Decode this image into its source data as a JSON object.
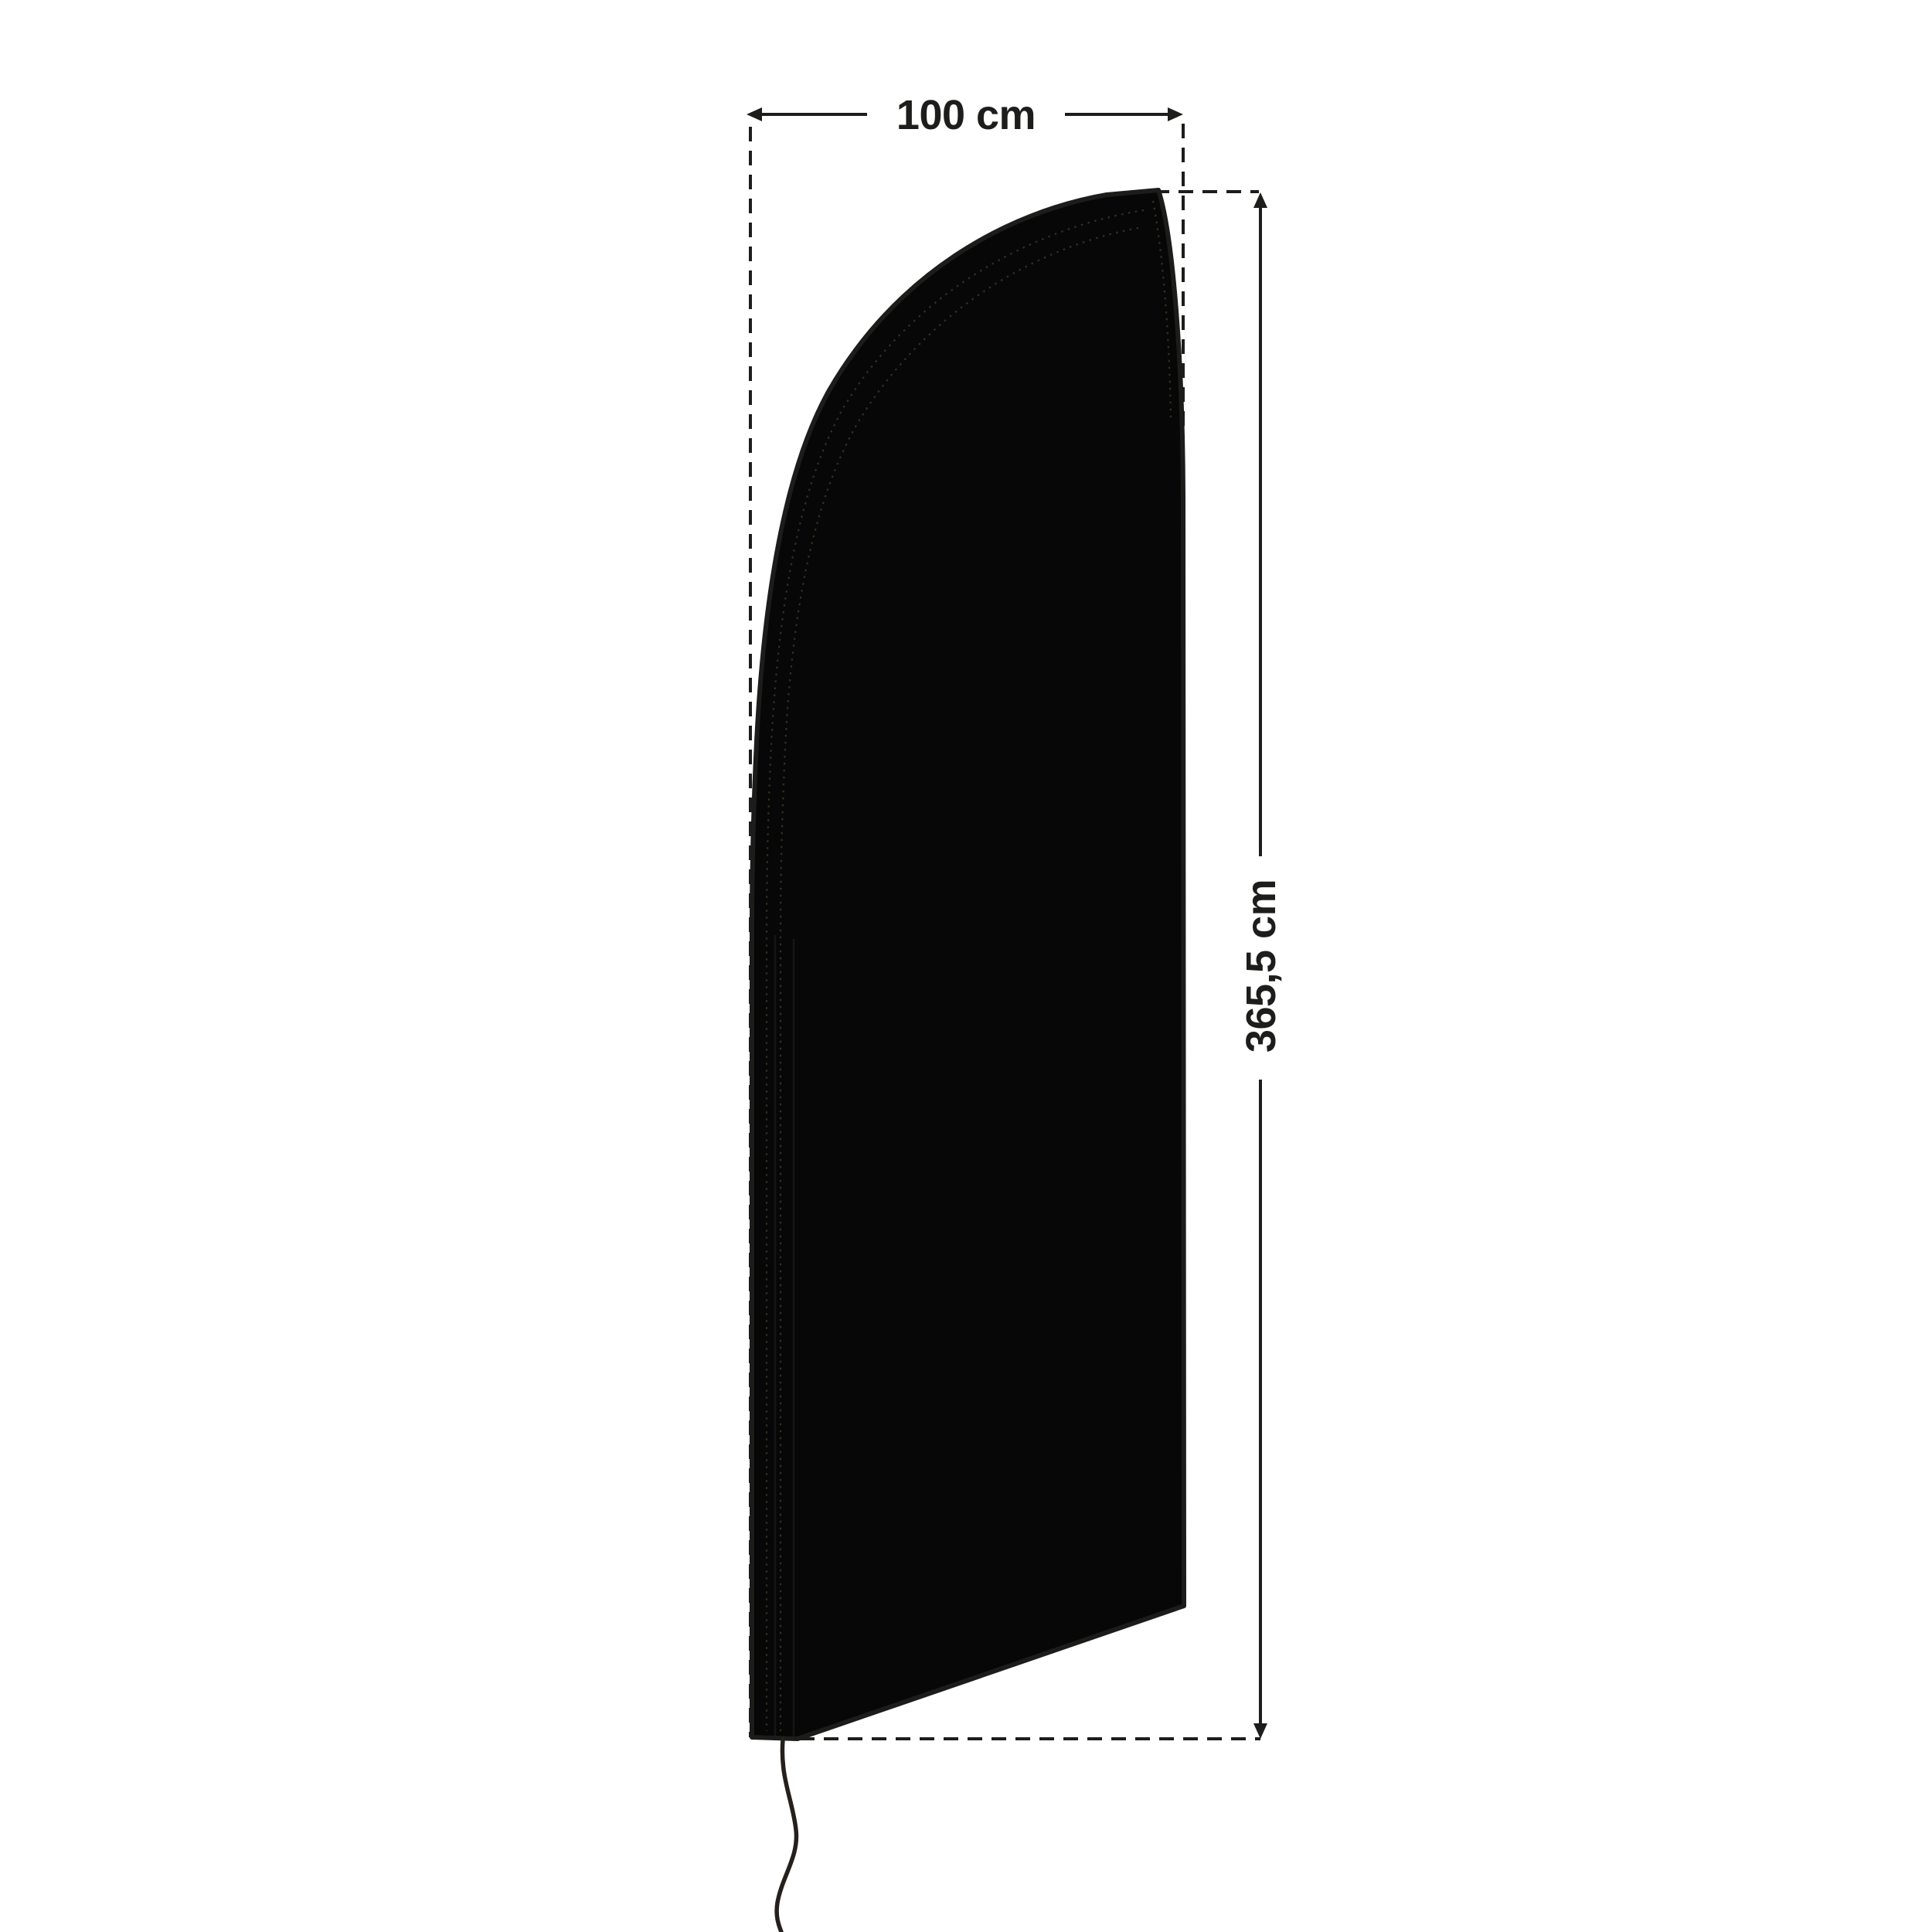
{
  "diagram": {
    "width_dimension": {
      "label": "100 cm"
    },
    "height_dimension": {
      "label": "365,5 cm"
    },
    "colors": {
      "background": "#ffffff",
      "flag_fill": "#070707",
      "flag_outline": "#1c1c1a",
      "dimension_line": "#1d1d1b",
      "stitch_seam": "#3a3a28",
      "cord": "#25201b"
    }
  }
}
